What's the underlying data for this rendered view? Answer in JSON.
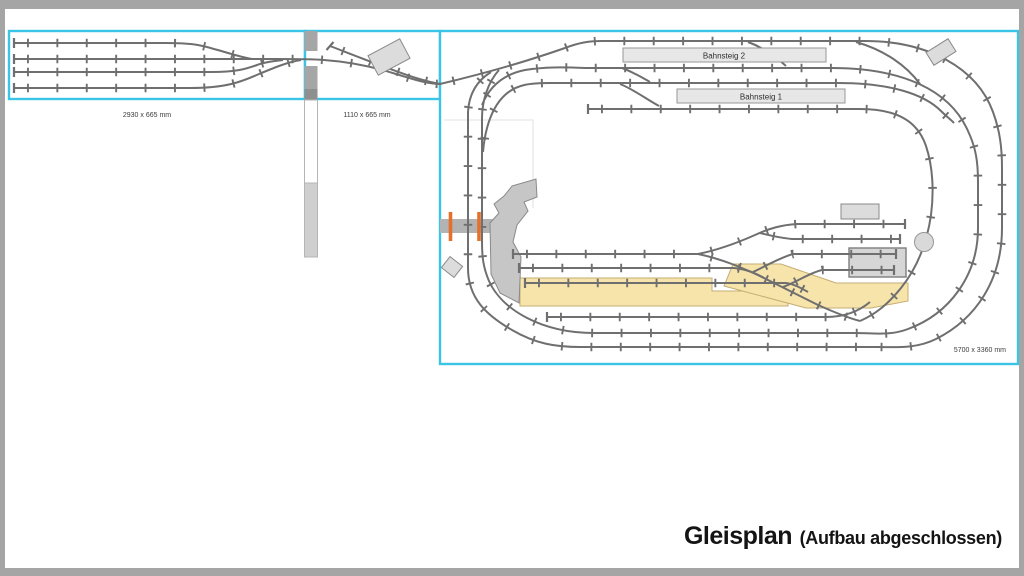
{
  "title": {
    "main": "Gleisplan",
    "annotation": "(Aufbau abgeschlossen)"
  },
  "boards": [
    {
      "id": "fiddle-yard-board",
      "dimension_label": "2930 x 665 mm"
    },
    {
      "id": "connector-board",
      "dimension_label": "1110 x 665 mm"
    },
    {
      "id": "main-board",
      "dimension_label": "5700 x 3360 mm"
    }
  ],
  "labels": {
    "platform_2": "Bahnsteig 2",
    "platform_1": "Bahnsteig 1"
  },
  "colors": {
    "board_outline_cyan": "#3ac5e6",
    "track_gray": "#6f6f6f",
    "loading_area_yellow": "#f7e4ab",
    "loading_area_outline": "#c4ae74",
    "highlight_marker_orange": "#e4702a",
    "building_gray": "#dcdcdc",
    "platform_gray": "#e7e7e7",
    "frame_gray": "#a5a5a5"
  }
}
